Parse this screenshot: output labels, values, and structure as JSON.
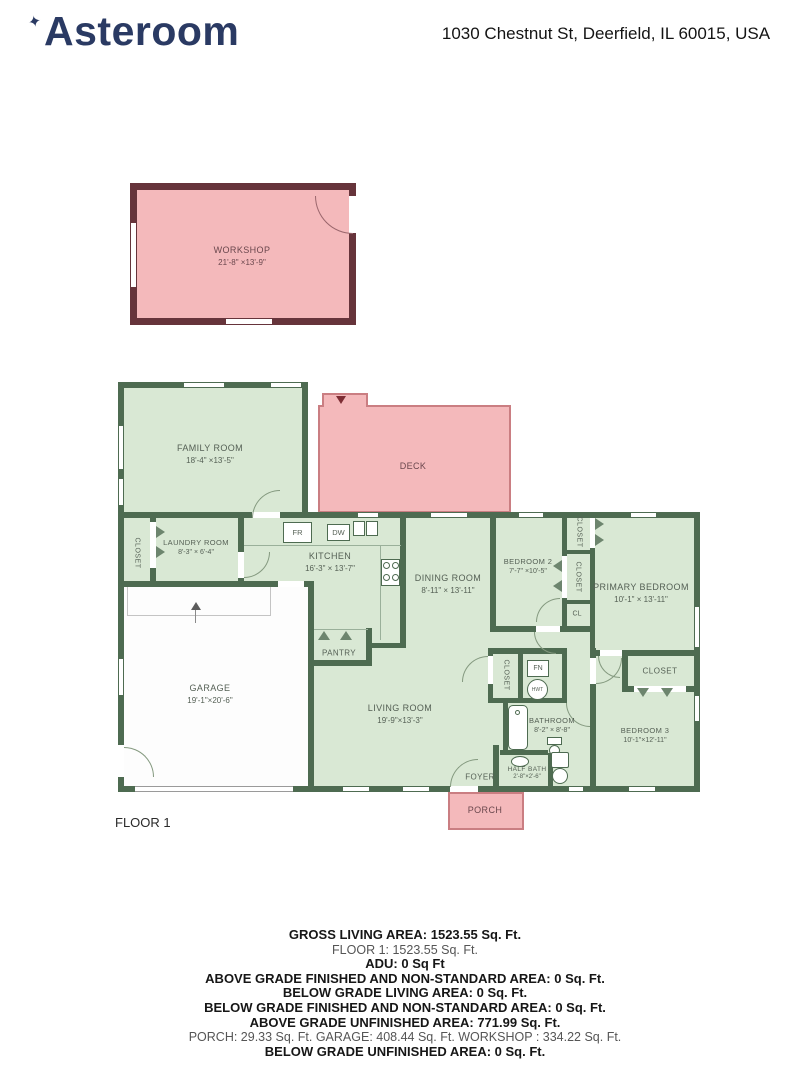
{
  "header": {
    "brand": "Asteroom",
    "address": "1030 Chestnut St, Deerfield, IL 60015, USA"
  },
  "icons": {
    "sparkle": "✦"
  },
  "floor_label": "FLOOR 1",
  "colors": {
    "wall_green": "#4e6b51",
    "room_fill": "#d9e8d4",
    "wall_maroon": "#66343b",
    "pink_fill": "#f4b9bb",
    "brand_navy": "#2a3a63"
  },
  "rooms": {
    "workshop": {
      "name": "WORKSHOP",
      "dims": "21'-8\" ×13'-9\""
    },
    "family": {
      "name": "FAMILY ROOM",
      "dims": "18'-4\" ×13'-5\""
    },
    "deck": {
      "name": "DECK"
    },
    "laundry": {
      "name": "LAUNDRY ROOM",
      "dims": "8'-3\" × 6'-4\""
    },
    "kitchen": {
      "name": "KITCHEN",
      "dims": "16'-3\" × 13'-7\""
    },
    "dining": {
      "name": "DINING ROOM",
      "dims": "8'-11\" × 13'-11\""
    },
    "bedroom2": {
      "name": "BEDROOM 2",
      "dims": "7'-7\" ×10'-5\""
    },
    "primary": {
      "name": "PRIMARY BEDROOM",
      "dims": "10'-1\" × 13'-11\""
    },
    "garage": {
      "name": "GARAGE",
      "dims": "19'-1\"×20'-6\""
    },
    "pantry": {
      "name": "PANTRY"
    },
    "living": {
      "name": "LIVING ROOM",
      "dims": "19'-9\"×13'-3\""
    },
    "bathroom": {
      "name": "BATHROOM",
      "dims": "8'-2\" × 8'-8\""
    },
    "halfbath": {
      "name": "HALF BATH",
      "dims": "2'-8\"×2'-6\""
    },
    "bedroom3": {
      "name": "BEDROOM 3",
      "dims": "10'-1\"×12'-11\""
    },
    "foyer": {
      "name": "FOYER"
    },
    "porch": {
      "name": "PORCH"
    },
    "closet": "CLOSET",
    "cl": "CL"
  },
  "appliances": {
    "fridge": "FR",
    "dishwasher": "DW",
    "furnace": "FN",
    "water_heater": "HWT"
  },
  "summary": {
    "lines": [
      {
        "text": "GROSS LIVING AREA: 1523.55 Sq. Ft.",
        "style": "bold"
      },
      {
        "text": "FLOOR 1: 1523.55 Sq. Ft.",
        "style": "regular"
      },
      {
        "text": "ADU: 0 Sq Ft",
        "style": "bold"
      },
      {
        "text": "ABOVE GRADE FINISHED AND NON-STANDARD AREA: 0 Sq. Ft.",
        "style": "bold"
      },
      {
        "text": "BELOW GRADE LIVING AREA: 0 Sq. Ft.",
        "style": "bold"
      },
      {
        "text": "BELOW GRADE FINISHED AND NON-STANDARD AREA: 0 Sq. Ft.",
        "style": "bold"
      },
      {
        "text": "ABOVE GRADE UNFINISHED AREA: 771.99 Sq. Ft.",
        "style": "bold"
      },
      {
        "text": "PORCH: 29.33 Sq. Ft. GARAGE: 408.44 Sq. Ft. WORKSHOP : 334.22 Sq. Ft.",
        "style": "regular"
      },
      {
        "text": "BELOW GRADE UNFINISHED AREA: 0 Sq. Ft.",
        "style": "bold"
      }
    ]
  }
}
